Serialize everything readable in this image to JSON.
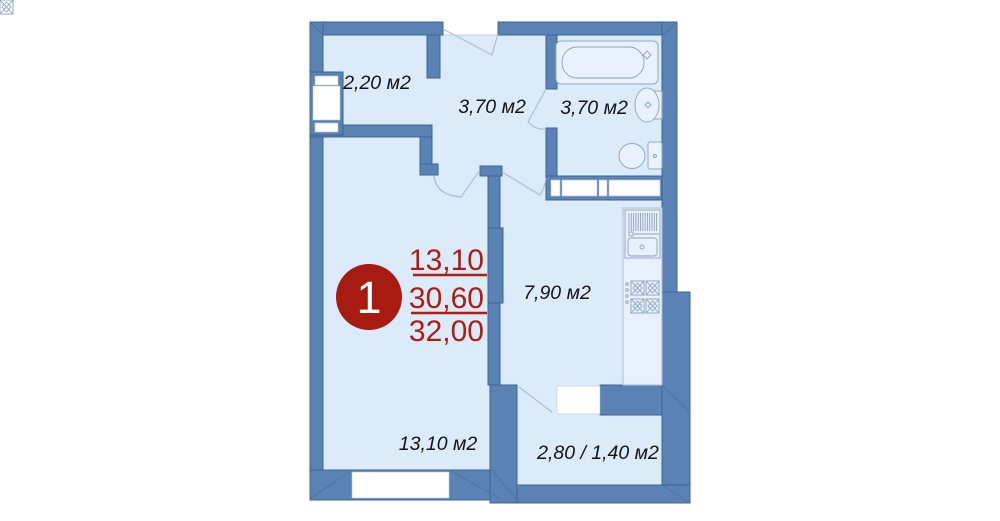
{
  "unit": {
    "number": "1",
    "living_area": "13,10",
    "usable_area": "30,60",
    "total_area": "32,00"
  },
  "rooms": {
    "entry_hall": "2,20 м2",
    "hallway": "3,70 м2",
    "bathroom": "3,70 м2",
    "kitchen": "7,90 м2",
    "living_room": "13,10 м2",
    "balcony": "2,80 / 1,40 м2"
  },
  "colors": {
    "wall": "#5a82b4",
    "floor": "#dcebfa",
    "accent_red": "#b01b12",
    "badge_red": "#a81b10",
    "fixture_line": "#93a9c2"
  }
}
